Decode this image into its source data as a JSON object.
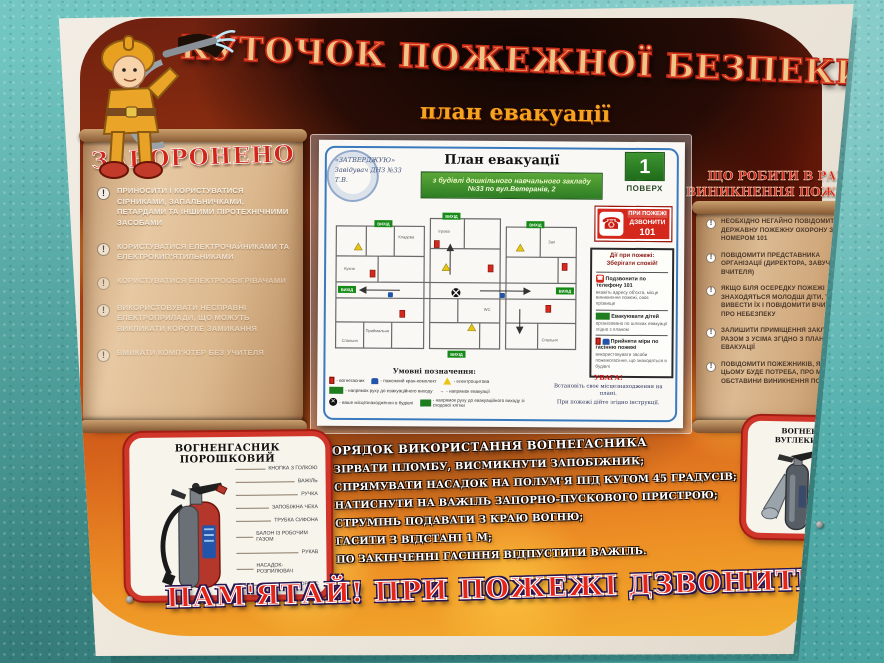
{
  "poster": {
    "title": "КУТОЧОК ПОЖЕЖНОЇ БЕЗПЕКИ",
    "subtitle": "план евакуації",
    "bottom_banner": "ПАМ'ЯТАЙ! ПРИ ПОЖЕЖІ ДЗВОНИТИ - 101"
  },
  "prohibited": {
    "title": "ЗАБОРОНЕНО",
    "items": [
      "ПРИНОСИТИ І КОРИСТУВАТИСЯ СІРНИКАМИ, ЗАПАЛЬНИЧКАМИ, ПЕТАРДАМИ ТА ІНШИМИ ПІРОТЕХНІЧНИМИ ЗАСОБАМИ",
      "КОРИСТУВАТИСЯ ЕЛЕКТРОЧАЙНИКАМИ ТА ЕЛЕКТРОКИП'ЯТИЛЬНИКАМИ",
      "КОРИСТУВАТИСЯ ЕЛЕКТРООБІГРІВАЧАМИ",
      "ВИКОРИСТОВУВАТИ НЕСПРАВНІ ЕЛЕКТРОПРИЛАДИ, ЩО МОЖУТЬ ВИКЛИКАТИ КОРОТКЕ ЗАМИКАННЯ",
      "ВМИКАТИ КОМП'ЮТЕР БЕЗ УЧИТЕЛЯ"
    ],
    "icon": "!"
  },
  "what_to_do": {
    "title": "ЩО РОБИТИ В РАЗІ ВИНИКНЕННЯ ПОЖЕЖІ!",
    "items": [
      "НЕОБХІДНО НЕГАЙНО ПОВІДОМИТИ ДЕРЖАВНУ ПОЖЕЖНУ ОХОРОНУ ЗА НОМЕРОМ 101",
      "ПОВІДОМИТИ ПРЕДСТАВНИКА ОРГАНІЗАЦІЇ (ДИРЕКТОРА, ЗАВУЧА, ВЧИТЕЛЯ)",
      "ЯКЩО БІЛЯ ОСЕРЕДКУ ПОЖЕЖІ ЗНАХОДЯТЬСЯ МОЛОДШІ ДІТИ, ТРЕБА ВИВЕСТИ ЇХ І ПОВІДОМИТИ ВЧИТЕЛЯ ПРО НЕБЕЗПЕКУ",
      "ЗАЛИШИТИ ПРИМІЩЕННЯ ЗАКЛАДУ РАЗОМ З УСІМА ЗГІДНО З ПЛАНОМ ЕВАКУАЦІЇ",
      "ПОВІДОМИТИ ПОЖЕЖНИКІВ, ЯКЩО В ЦЬОМУ БУДЕ ПОТРЕБА, ПРО МІСЦЕ Й ОБСТАВИНИ ВИНИКНЕННЯ ПОЖЕЖІ"
    ],
    "icon": "!"
  },
  "plan": {
    "title": "План евакуації",
    "banner_line1": "з будівлі дошкільного навчального закладу",
    "banner_line2": "№33 по вул.Ветеранів, 2",
    "floor_number": "1",
    "floor_label": "ПОВЕРХ",
    "stamp_line1": "«ЗАТВЕРДЖУЮ»",
    "stamp_line2": "Завідувач ДНЗ №33",
    "stamp_line3": "Т.В.",
    "call_line1": "ПРИ ПОЖЕЖІ",
    "call_line2": "ДЗВОНИТИ",
    "call_line3": "101",
    "phone_glyph": "☎",
    "exit_label": "ВИХІД",
    "rooms": [
      "Кухня",
      "Кладова",
      "Приймальня",
      "Спальня",
      "Ігрова",
      "Зал",
      "Спальня",
      "WC"
    ],
    "actions_box": {
      "title_line1": "Дії при пожежі:",
      "title_line2": "Зберігати спокій!",
      "items": [
        {
          "num": "1",
          "head": "Подзвонити по телефону 101",
          "sub": "вкажіть адресу об'єкта, місце виникнення пожежі, своє прізвище"
        },
        {
          "num": "2",
          "head": "Евакуювати дітей",
          "sub": "організовано по шляхах евакуації згідно з планом"
        },
        {
          "num": "3",
          "head": "Прийняти міри по гасінню пожежі",
          "sub": "використовувати засоби пожежогасіння, що знаходяться в будівлі"
        }
      ]
    },
    "legend": {
      "title": "Умовні позначення:",
      "items": [
        "- вогнегасник",
        "- пожежний кран-комплект",
        "- електрощитова",
        "- напрямок руху до евакуаційного виходу",
        "- напрямок евакуації",
        "- ваше місцезнаходження в будівлі",
        "- напрямок руху до евакуаційного виходу зі сходової клітки"
      ],
      "attention": "УВАГА!",
      "note1": "Встановіть своє місцезнаходження на плані.",
      "note2": "При пожежі дійте згідно інструкції."
    }
  },
  "usage": {
    "title": "ПОРЯДОК ВИКОРИСТАННЯ ВОГНЕГАСНИКА",
    "bullet": "•",
    "items": [
      "ЗІРВАТИ ПЛОМБУ, ВИСМИКНУТИ ЗАПОБІЖНИК;",
      "СПРЯМУВАТИ НАСАДОК НА ПОЛУМ'Я ПІД КУТОМ 45 ГРАДУСІВ;",
      "НАТИСНУТИ НА ВАЖІЛЬ ЗАПОРНО-ПУСКОВОГО ПРИСТРОЮ;",
      "СТРУМІНЬ ПОДАВАТИ З КРАЮ ВОГНЮ;",
      "ГАСИТИ З ВІДСТАНІ 1 М;",
      "ПО ЗАКІНЧЕННІ ГАСІННЯ ВІДПУСТИТИ ВАЖІЛЬ."
    ]
  },
  "powder_ext": {
    "title": "ВОГНЕНГАСНИК ПОРОШКОВИЙ",
    "labels": [
      "КНОПКА З ГОЛКОЮ",
      "ВАЖІЛЬ",
      "РУЧКА",
      "ЗАПОБІЖНА ЧЕКА",
      "ТРУБКА СИФОНА",
      "БАЛОН ІЗ РОБОЧИМ ГАЗОМ",
      "РУКАВ",
      "НАСАДОК-РОЗПИЛЮВАЧ",
      "КОРПУС"
    ]
  },
  "co2_ext": {
    "title": "ВОГНЕНГАСНИК ВУГЛЕКИСЛОТНИЙ",
    "labels": [
      "ВАЖІЛЬ-КРИШКА З КЛАПАНОМ",
      "РУЧКА",
      "ЗАПОБІЖНА ЧЕКА",
      "ТРУБКА СИФОНА",
      "РОЗТРУБ",
      "КОРПУС"
    ]
  },
  "colors": {
    "wall_teal": "#5fbab6",
    "fire_orange": "#d8651c",
    "accent_red": "#d5281c",
    "exit_green": "#1f7d1f",
    "parchment": "#dcb88e"
  }
}
